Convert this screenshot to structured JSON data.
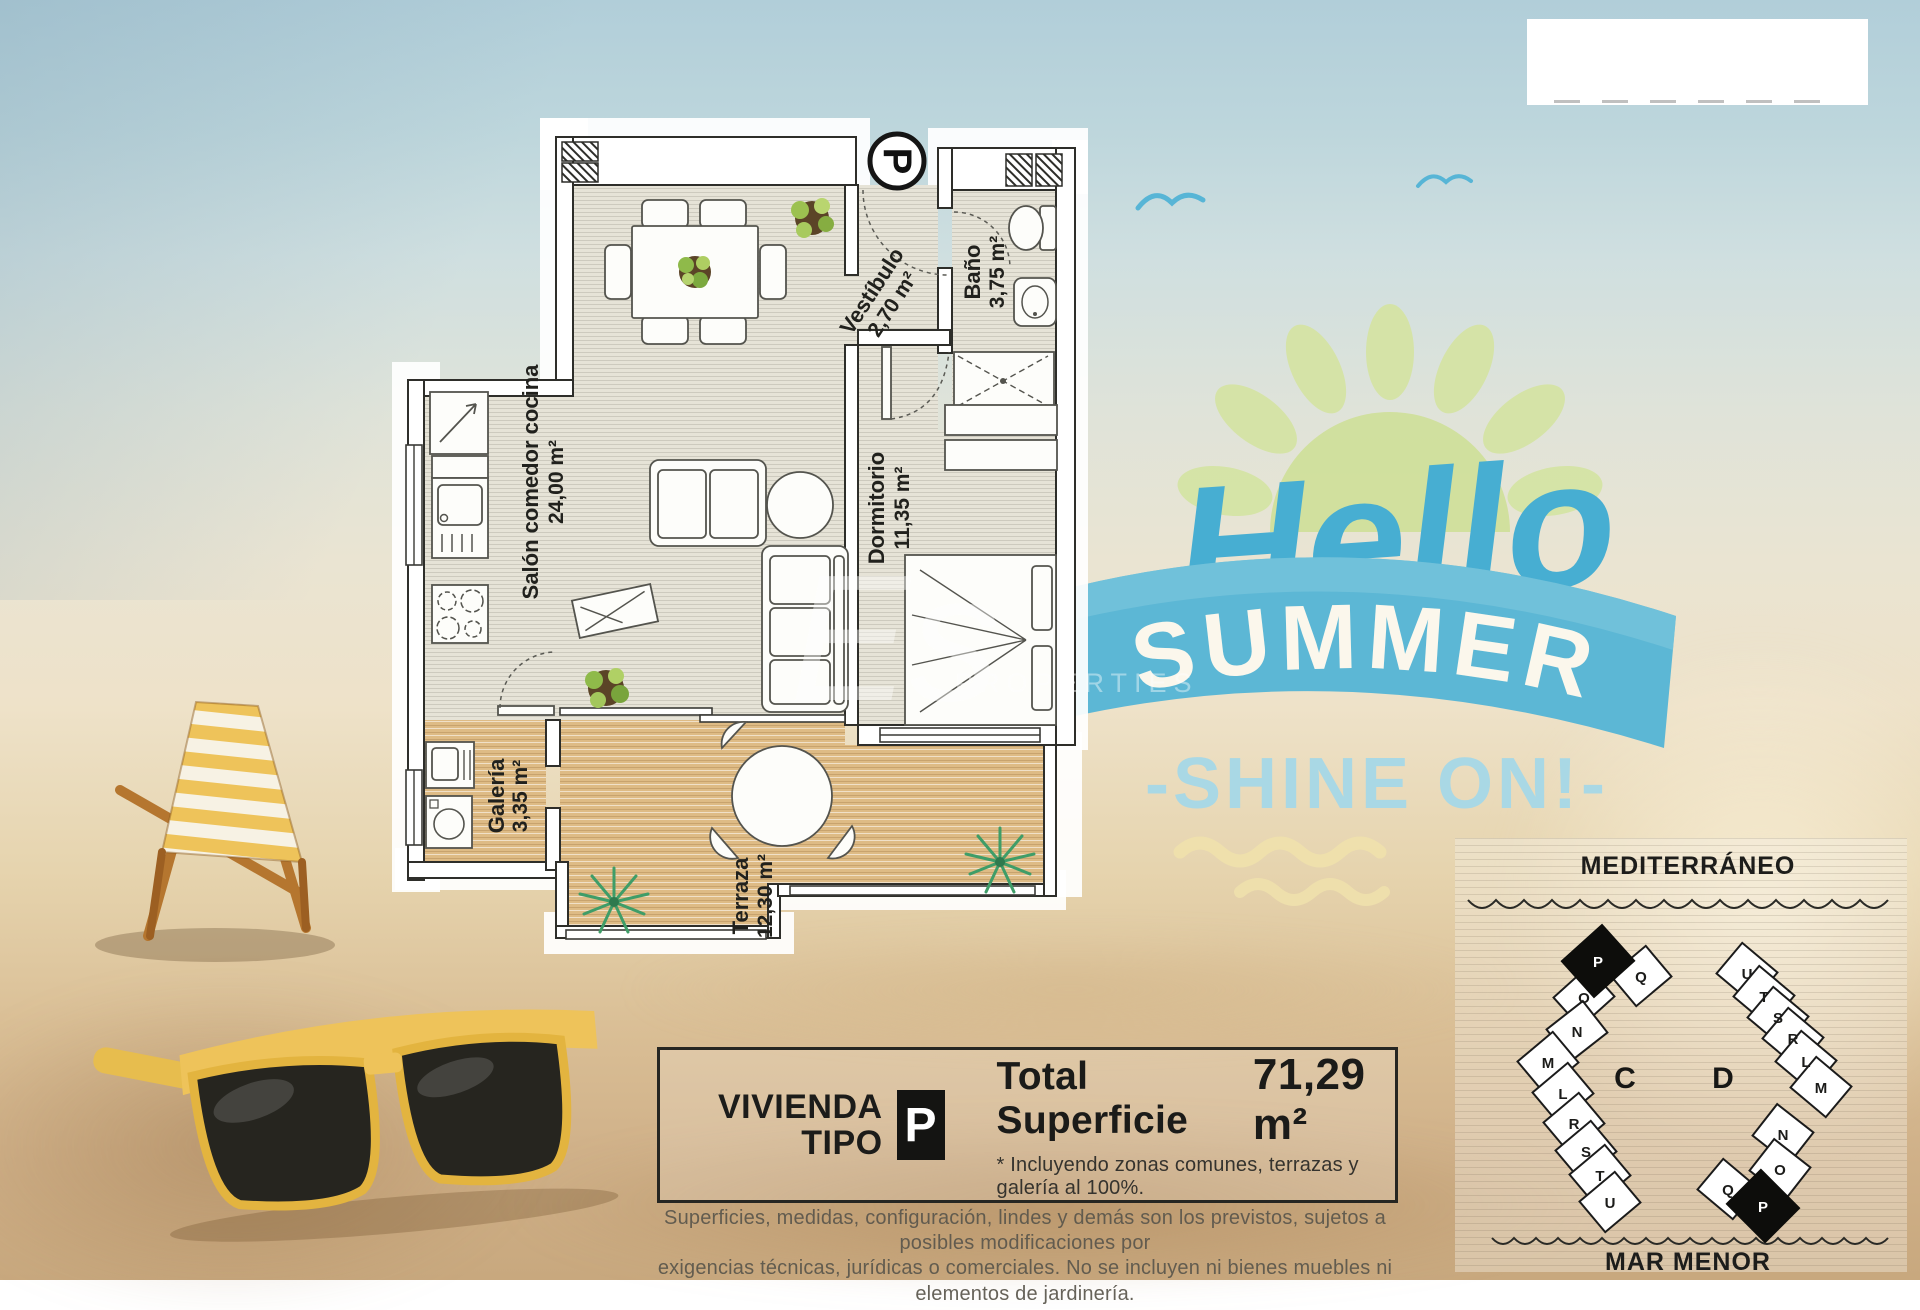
{
  "floor_plan": {
    "type_marker": "P",
    "rooms": [
      {
        "name": "Salón comedor cocina",
        "area": "24,00 m²"
      },
      {
        "name": "Vestíbulo",
        "area": "2,70 m²"
      },
      {
        "name": "Baño",
        "area": "3,75 m²"
      },
      {
        "name": "Dormitorio",
        "area": "11,35 m²"
      },
      {
        "name": "Galería",
        "area": "3,35 m²"
      },
      {
        "name": "Terraza",
        "area": "12,30 m²"
      }
    ],
    "watermark_script": "Es",
    "watermark_caps": "PROPERTIES"
  },
  "promo": {
    "greeting": "Hello",
    "banner": "SUMMER",
    "tagline": "-SHINE ON!-"
  },
  "site_map": {
    "sea_top": "MEDITERRÁNEO",
    "sea_bottom": "MAR MENOR",
    "blocks": [
      {
        "label": "C",
        "units": [
          "P",
          "Q",
          "O",
          "N",
          "M",
          "L",
          "R",
          "S",
          "T",
          "U"
        ],
        "highlighted_unit": "P"
      },
      {
        "label": "D",
        "units": [
          "U",
          "T",
          "S",
          "R",
          "L",
          "M",
          "N",
          "O",
          "Q",
          "P"
        ],
        "highlighted_unit": "P"
      }
    ]
  },
  "summary_box": {
    "dwelling_word": "VIVIENDA",
    "type_word": "TIPO",
    "type_badge": "P",
    "total_label": "Total Superficie",
    "total_value": "71,29 m²",
    "note": "* Incluyendo zonas comunes, terrazas y galería al 100%."
  },
  "disclaimer": {
    "line1": "Superficies, medidas, configuración, lindes y demás son los previstos, sujetos a posibles modificaciones por",
    "line2": "exigencias técnicas, jurídicas o comerciales. No se incluyen ni bienes muebles ni elementos de jardinería."
  },
  "colors": {
    "promo_blue": "#47aed2",
    "ribbon_blue": "#5cb7d5",
    "tagline_blue": "#a9d8e5",
    "sun_green": "#d3e3a6",
    "badge_black": "#141412",
    "wood_floor": "#debb85",
    "room_floor": "#e6e3d7"
  }
}
